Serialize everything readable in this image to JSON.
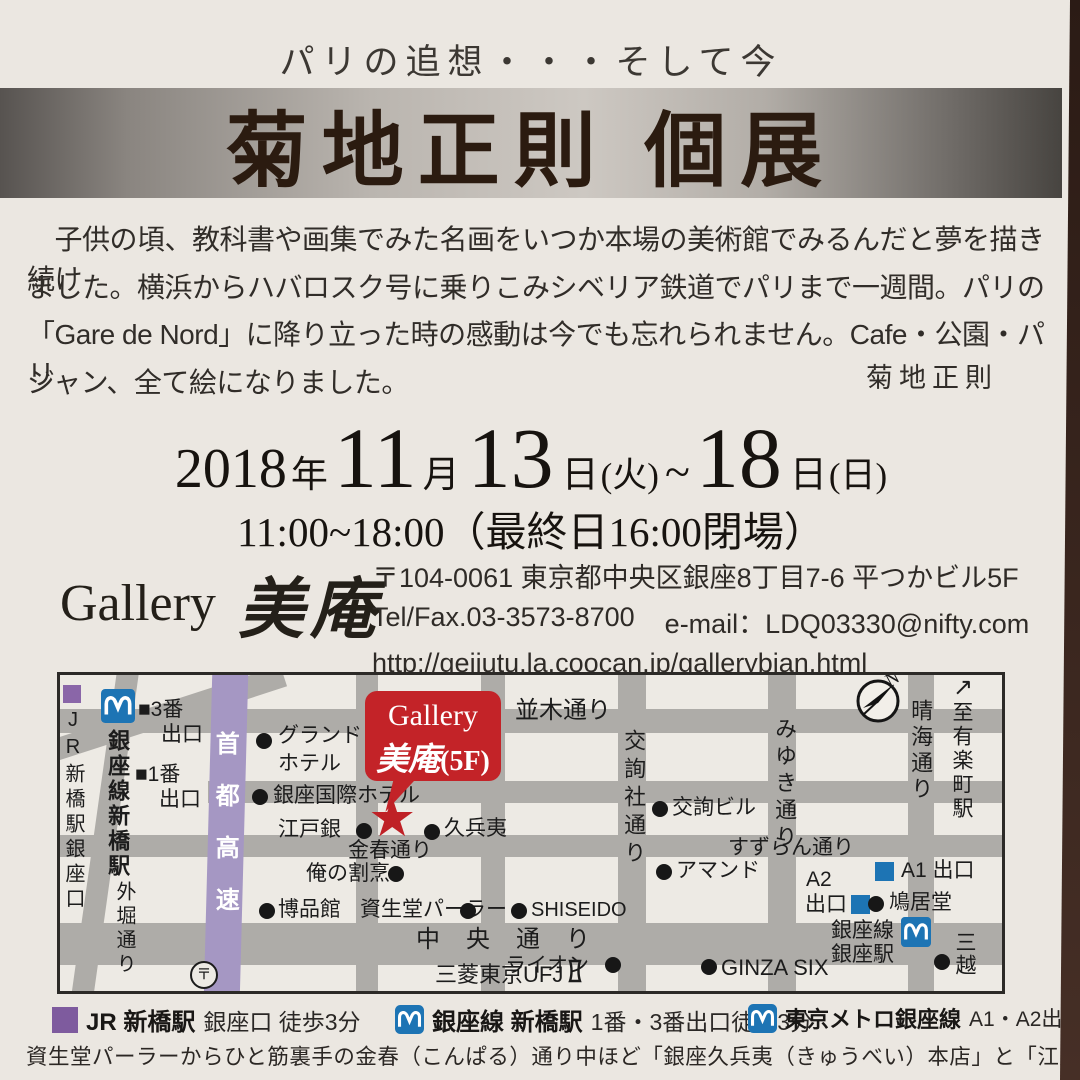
{
  "tagline": "パリの追想・・・そして今",
  "title": "菊地正則 個展",
  "intro": {
    "lines": [
      "　子供の頃、教科書や画集でみた名画をいつか本場の美術館でみるんだと夢を描き続け",
      "ました。横浜からハバロスク号に乗りこみシベリア鉄道でパリまで一週間。パリの",
      "「Gare de Nord」に降り立った時の感動は今でも忘れられません。Cafe・公園・パリ",
      "ジャン、全て絵になりました。"
    ],
    "signature": "菊地正則"
  },
  "schedule": {
    "year": "2018",
    "year_unit": "年",
    "month": "11",
    "month_unit": "月",
    "day1": "13",
    "day1_unit": "日",
    "day1_week": "(火)",
    "tilde": "~",
    "day2": "18",
    "day2_unit": "日",
    "day2_week": "(日)",
    "hours": "11:00~18:00（最終日16:00閉場）"
  },
  "gallery": {
    "name_en": "Gallery",
    "name_jp": "美庵",
    "address": "〒104-0061 東京都中央区銀座8丁目7-6 平つかビル5F",
    "tel": "Tel/Fax.03-3573-8700",
    "email": "e-mail：LDQ03330@nifty.com",
    "url": "http://geijutu.la.coocan.jp/gallerybian.html"
  },
  "map": {
    "bubble": {
      "en": "Gallery",
      "jp": "美庵",
      "floor": "(5F)"
    },
    "compass_n": "N",
    "labels": {
      "jr_station_vert": "JR新橋駅銀座口",
      "ginza_line_shimbashi_vert": "銀座線新橋駅",
      "exit3": "■3番",
      "exit3_b": "出口",
      "exit1": "■1番",
      "exit1_b": "出口",
      "shuto_expwy": "首都高速",
      "sotobori_vert": "外堀通り",
      "post_mark": "〒",
      "grand_hotel_1": "グランド",
      "grand_hotel_2": "ホテル",
      "ginza_kokusai": "銀座国際ホテル",
      "edogin": "江戸銀",
      "kyubei": "久兵夷",
      "konparu_dori": "金春通り",
      "ore_no_kappo": "俺の割烹",
      "hakuhinkan": "博品館",
      "shiseido_parlour": "資生堂パーラー",
      "shiseido": "SHISEIDO",
      "chuo_dori": "中央通り",
      "ufj": "三菱東京UFJ",
      "lion": "ライオン",
      "ginza_six": "GINZA SIX",
      "namiki_dori": "並木通り",
      "kojunsha_dori_vert": "交詢社通り",
      "kojun_bldg": "交詢ビル",
      "miyuki_dori_vert": "みゆき通り",
      "suzuran_dori": "すずらん通り",
      "amand": "アマンド",
      "a2": "A2",
      "a2_b": "出口",
      "a1": "A1 出口",
      "kyukyodo": "鳩居堂",
      "ginza_sta_1": "銀座線",
      "ginza_sta_2": "銀座駅",
      "mitsukoshi_vert": "三越",
      "harumi_dori_vert": "晴海通り",
      "to_yurakucho_arrow": "↗",
      "to_yurakucho_vert": "至有楽町駅"
    }
  },
  "legend": {
    "items": [
      {
        "name": "JR 新橋駅",
        "detail": "銀座口 徒歩3分"
      },
      {
        "name": "銀座線 新橋駅",
        "detail": "1番・3番出口徒歩3分"
      },
      {
        "name": "東京メトロ銀座線",
        "detail": "A1・A2出口徒歩5分"
      }
    ]
  },
  "footer": {
    "note": "資生堂パーラーからひと筋裏手の金春（こんぱる）通り中ほど「銀座久兵夷（きゅうべい）本店」と「江戸銀」の間"
  },
  "colors": {
    "accent_red": "#c32328",
    "metro_blue": "#1d74b4",
    "jr_purple": "#7e5b9e",
    "highway_purple": "#a597c3"
  }
}
